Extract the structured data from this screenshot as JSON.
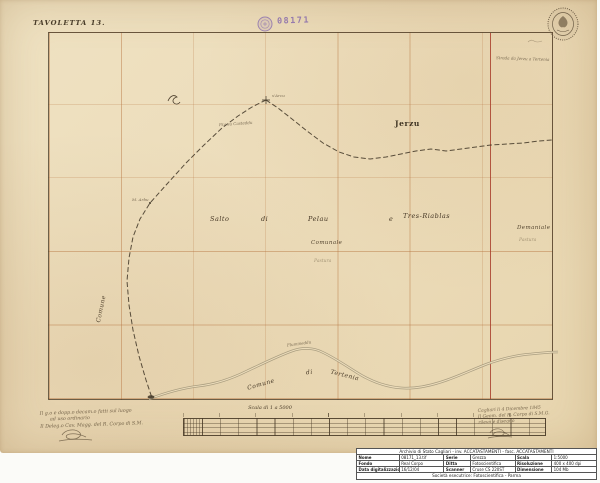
{
  "map": {
    "title": "TAVOLETTA 13.",
    "stamp_number": "08171",
    "labels": {
      "jerzu": "Jerzu",
      "salto": "Salto",
      "di": "di",
      "pelau": "Pelau",
      "e": "e",
      "tres_riablas": "Tres-Riablas",
      "comunale": "Comunale",
      "pastura": "Pastura",
      "demaniale": "Demaniale",
      "demaniale_sub": "Pastura",
      "comune_vertical": "Comune",
      "tertenia_comune": "Comune",
      "tertenia_di": "di",
      "tertenia_name": "Tertenia"
    },
    "tiny_labels": [
      {
        "text": "s'Arcu"
      },
      {
        "text": "P.ta su Casteddu"
      },
      {
        "text": "M. Arbu"
      },
      {
        "text": "Flumineddu"
      },
      {
        "text": "Strada da Jerzu a Tertenia"
      }
    ]
  },
  "scale_bar": {
    "label": "Scala di 1 a 5000"
  },
  "notes": {
    "left": {
      "line1": "Il g.o e dopp.o decam.o fatti sul luogo",
      "line2": "ad uso ordinario",
      "line3": "Il Deleg.o Cav. Magg. del R. Corpo di S.M."
    },
    "right": {
      "line1": "Cagliari li 4 Dicembre 1845",
      "line2": "Il Geom. del R. Corpo di S.M.G.",
      "line3": "rilevò e disegnò"
    }
  },
  "archive_table": {
    "header": "Archivio di Stato Cagliari - inv. ACCATASTAMENTI - fasc. ACCATASTAMENTI",
    "rows": [
      {
        "c1": "Nome",
        "v1": "08171_13.tif",
        "c2": "Serie",
        "v2": "Grezza",
        "c3": "Scala",
        "v3": "1:5000"
      },
      {
        "c1": "Fondo",
        "v1": "Real Corpo",
        "c2": "Ditta",
        "v2": "Fotoscientifica",
        "c3": "Risoluzione",
        "v3": "400 x 400 dpi"
      },
      {
        "c1": "Data digitalizzazione",
        "v1": "16/12/04",
        "c2": "Scanner",
        "v2": "Cruse CS 220ST",
        "c3": "Dimensione",
        "v3": "104 Mb"
      }
    ],
    "footer": "Società esecutrice: Fotoscientifica - Parma"
  }
}
